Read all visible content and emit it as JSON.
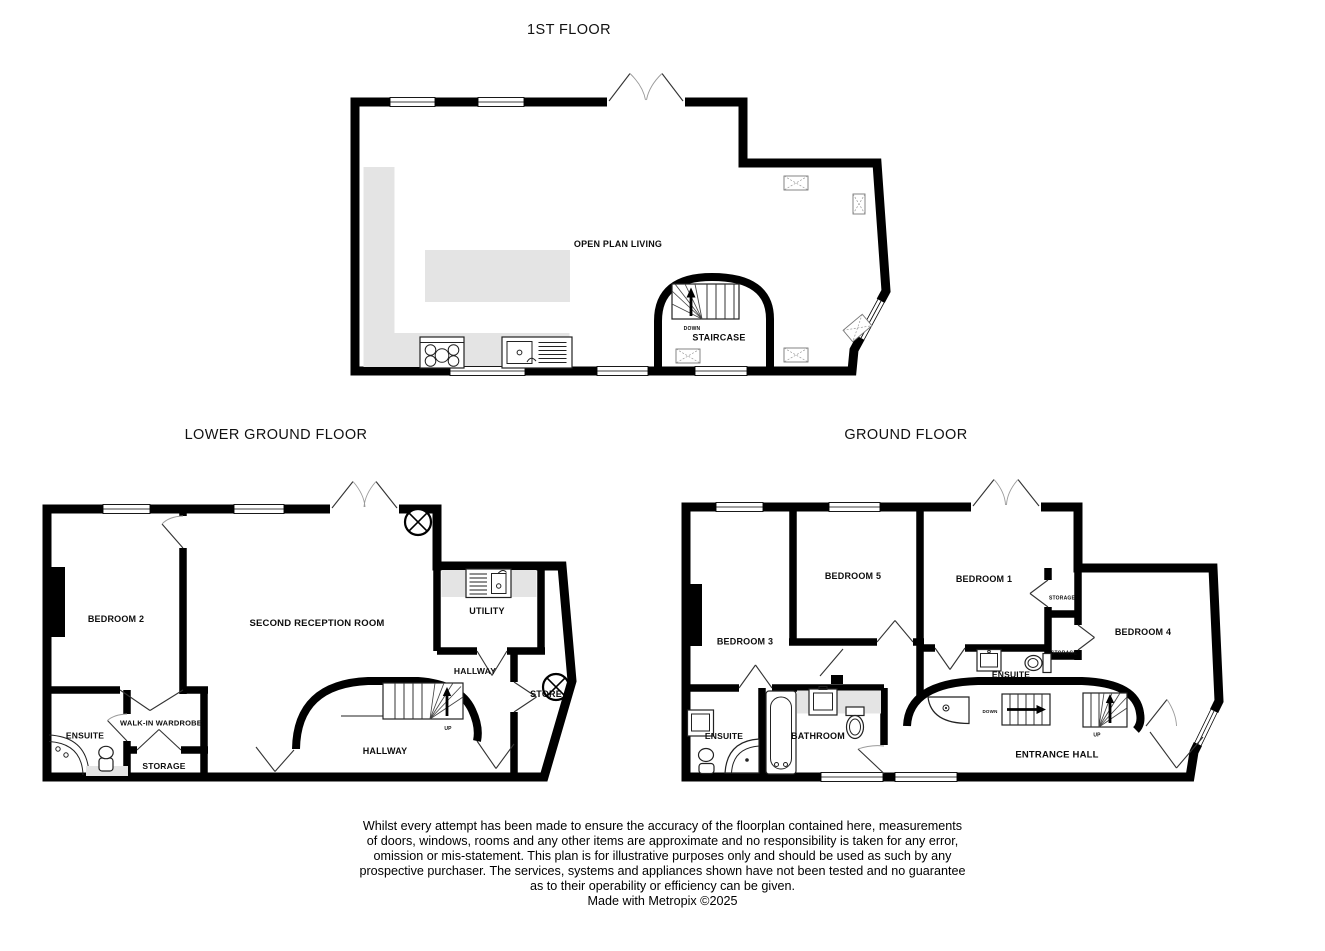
{
  "floors": {
    "first": {
      "title": "1ST FLOOR",
      "labels": {
        "open_plan_living": "OPEN PLAN LIVING",
        "staircase": "STAIRCASE",
        "down": "DOWN"
      }
    },
    "lower_ground": {
      "title": "LOWER GROUND FLOOR",
      "labels": {
        "bedroom2": "BEDROOM 2",
        "second_reception": "SECOND RECEPTION ROOM",
        "utility": "UTILITY",
        "hallway_upper": "HALLWAY",
        "store": "STORE",
        "hallway_lower": "HALLWAY",
        "walk_in_wardrobe": "WALK-IN WARDROBE",
        "ensuite": "ENSUITE",
        "storage": "STORAGE",
        "up": "UP"
      }
    },
    "ground": {
      "title": "GROUND FLOOR",
      "labels": {
        "bedroom3": "BEDROOM 3",
        "bedroom5": "BEDROOM 5",
        "bedroom1": "BEDROOM 1",
        "bedroom4": "BEDROOM 4",
        "storage_top": "STORAGE",
        "storage_mid": "STORAGE",
        "ensuite_inner": "ENSUITE",
        "ensuite_left": "ENSUITE",
        "bathroom": "BATHROOM",
        "entrance_hall": "ENTRANCE HALL",
        "down": "DOWN",
        "up": "UP"
      }
    }
  },
  "disclaimer": {
    "lines": [
      "Whilst every attempt has been made to ensure the accuracy of the floorplan contained here, measurements",
      "of doors, windows, rooms and any other items are approximate and no responsibility is taken for any error,",
      "omission or mis-statement. This plan is for illustrative purposes only and should be used as such by any",
      "prospective purchaser. The services, systems and appliances shown have not been tested and no guarantee",
      "as to their operability or efficiency can be given."
    ],
    "credit": "Made with Metropix ©2025"
  },
  "colors": {
    "wall": "#000000",
    "counter": "#e4e4e4",
    "background": "#ffffff"
  }
}
